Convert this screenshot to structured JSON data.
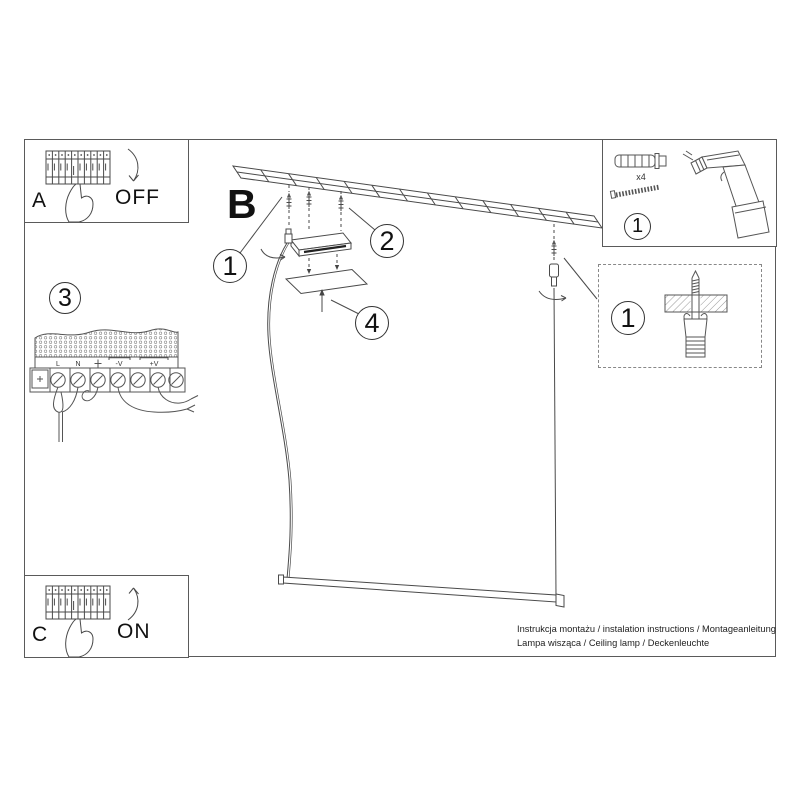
{
  "colors": {
    "line": "#4a4a4a",
    "text": "#222222"
  },
  "panel_a": {
    "letter": "A",
    "state": "OFF"
  },
  "panel_c": {
    "letter": "C",
    "state": "ON"
  },
  "step3": {
    "number": "3",
    "labels": {
      "l": "L",
      "n": "N",
      "neg": "-V",
      "pos": "+V"
    }
  },
  "main": {
    "letter": "B",
    "callout_hanger": "1",
    "callout_screws": "2",
    "callout_cover": "4"
  },
  "toolbox": {
    "number": "1",
    "qty": "x4"
  },
  "detailbox": {
    "number": "1"
  },
  "footer": {
    "line1": "Instrukcja montażu / instalation instructions / Montageanleitung",
    "line2": "Lampa wisząca / Ceiling lamp / Deckenleuchte"
  }
}
